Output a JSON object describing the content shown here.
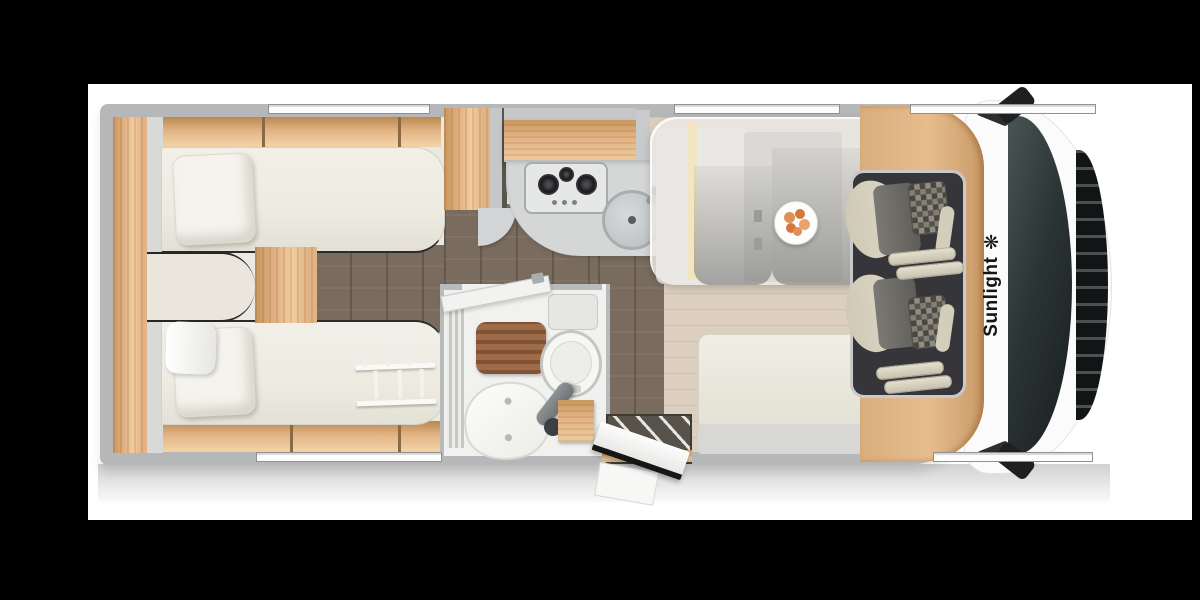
{
  "brand": {
    "name": "Sunlight",
    "flower_icon": "❋"
  },
  "icons": {
    "logo": "flower-icon"
  },
  "colors": {
    "background": "#000000",
    "panel": "#ffffff",
    "wall": "#b6b7b9",
    "interior": "#eae8e2",
    "wood": "#e2b385",
    "wood_dark": "#c8965f",
    "floor_dark": "#7a6b5f",
    "floor_light": "#dccfbf",
    "mattress": "#eeebe1",
    "pillow": "#f5f3ed",
    "overlay": "rgba(234,233,229,0.82)",
    "table": "#90918f",
    "seat_cream": "#d6d1bf",
    "seat_grey": "#6e6c66",
    "cab_floor": "#36363a",
    "glass": "#2c3536",
    "grille": "#121516",
    "cab_white": "#fbfbfb",
    "counter": "#d5d7d7",
    "burner": "#1c1c1e",
    "bath_floor": "#f1f1ef",
    "mat_brown": "#a06b4a",
    "mat_slat": "#7e5434",
    "food_orange": "#dd8349",
    "logo_black": "#151515",
    "step_dark": "#57524a"
  }
}
